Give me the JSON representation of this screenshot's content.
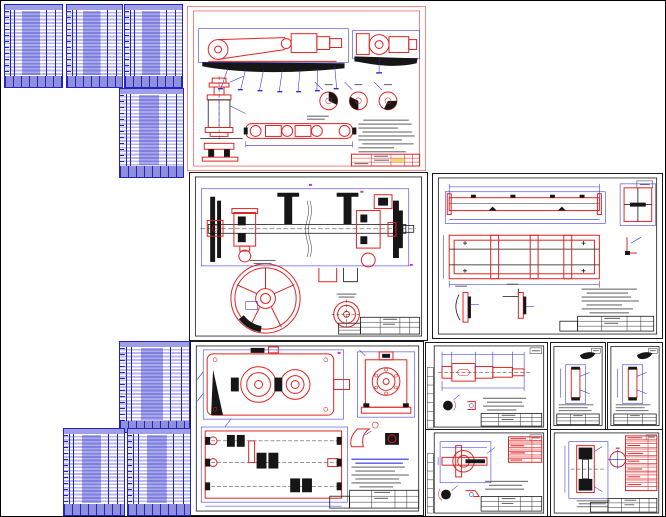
{
  "page": {
    "title": "Engineering CAD drawing package preview",
    "background": "#ffffff",
    "border_color": "#000000",
    "width_px": 666,
    "height_px": 517
  },
  "palette": {
    "table_blue": "#2424c0",
    "table_row_fill": "#b9b9ef",
    "drawing_red": "#e02222",
    "dimension_blue": "#2b2bdd",
    "line_black": "#161616",
    "red_sheet_border": "#f28a8a",
    "notes_gray": "#6b6b6b",
    "highlight_yellow": "#f3d95a",
    "accent_magenta": "#d22ad2",
    "pink_fill": "#f6b9b9"
  },
  "sheets": [
    {
      "id": "spec-1",
      "kind": "specification-table",
      "title": "Specification table, sheet 1 (blue ink, illegible micro-text)"
    },
    {
      "id": "spec-2",
      "kind": "specification-table",
      "title": "Specification table, sheet 2 (blue ink, illegible micro-text)"
    },
    {
      "id": "spec-3",
      "kind": "specification-table",
      "title": "Specification table, sheet 3 (blue ink, illegible micro-text)"
    },
    {
      "id": "spec-4",
      "kind": "specification-table",
      "title": "Specification table, sheet 4 (blue ink, illegible micro-text)"
    },
    {
      "id": "assembly",
      "kind": "drawing",
      "title": "General view assembly drawing, red-border sheet: conveyor drive, motor, roller, detail sections, notes, title block"
    },
    {
      "id": "shaft-assembly",
      "kind": "drawing",
      "title": "Drive shaft assembly drawing with large spoked pulley wheel and section details"
    },
    {
      "id": "frame",
      "kind": "drawing",
      "title": "Welded frame drawing: side view, plan view, cross-section, weld details, notes, title block"
    },
    {
      "id": "gearbox",
      "kind": "drawing",
      "title": "Gearbox (reducer) assembly drawing: side view, end view, horizontal section, notes, title block"
    },
    {
      "id": "spec-5",
      "kind": "specification-table",
      "title": "Specification table, sheet 5 (blue ink, illegible micro-text)"
    },
    {
      "id": "spec-6",
      "kind": "specification-table",
      "title": "Specification table, sheet 6 (blue ink, illegible micro-text)"
    },
    {
      "id": "spec-7",
      "kind": "specification-table",
      "title": "Specification table, sheet 7 (blue ink, illegible micro-text)"
    },
    {
      "id": "shaft-detail",
      "kind": "drawing",
      "title": "Stepped shaft detail drawing with dimension chains and section details"
    },
    {
      "id": "detail-a4-1",
      "kind": "drawing",
      "title": "Small A4 part detail drawing 1 (bushing) with isometric sketch"
    },
    {
      "id": "detail-a4-2",
      "kind": "drawing",
      "title": "Small A4 part detail drawing 2 (bushing) with isometric sketch"
    },
    {
      "id": "coupling-detail",
      "kind": "drawing",
      "title": "Coupling / shaft-end detail drawing with red parameter table"
    },
    {
      "id": "gear-detail",
      "kind": "drawing",
      "title": "Gear wheel detail drawing with red gear-parameter table"
    }
  ]
}
